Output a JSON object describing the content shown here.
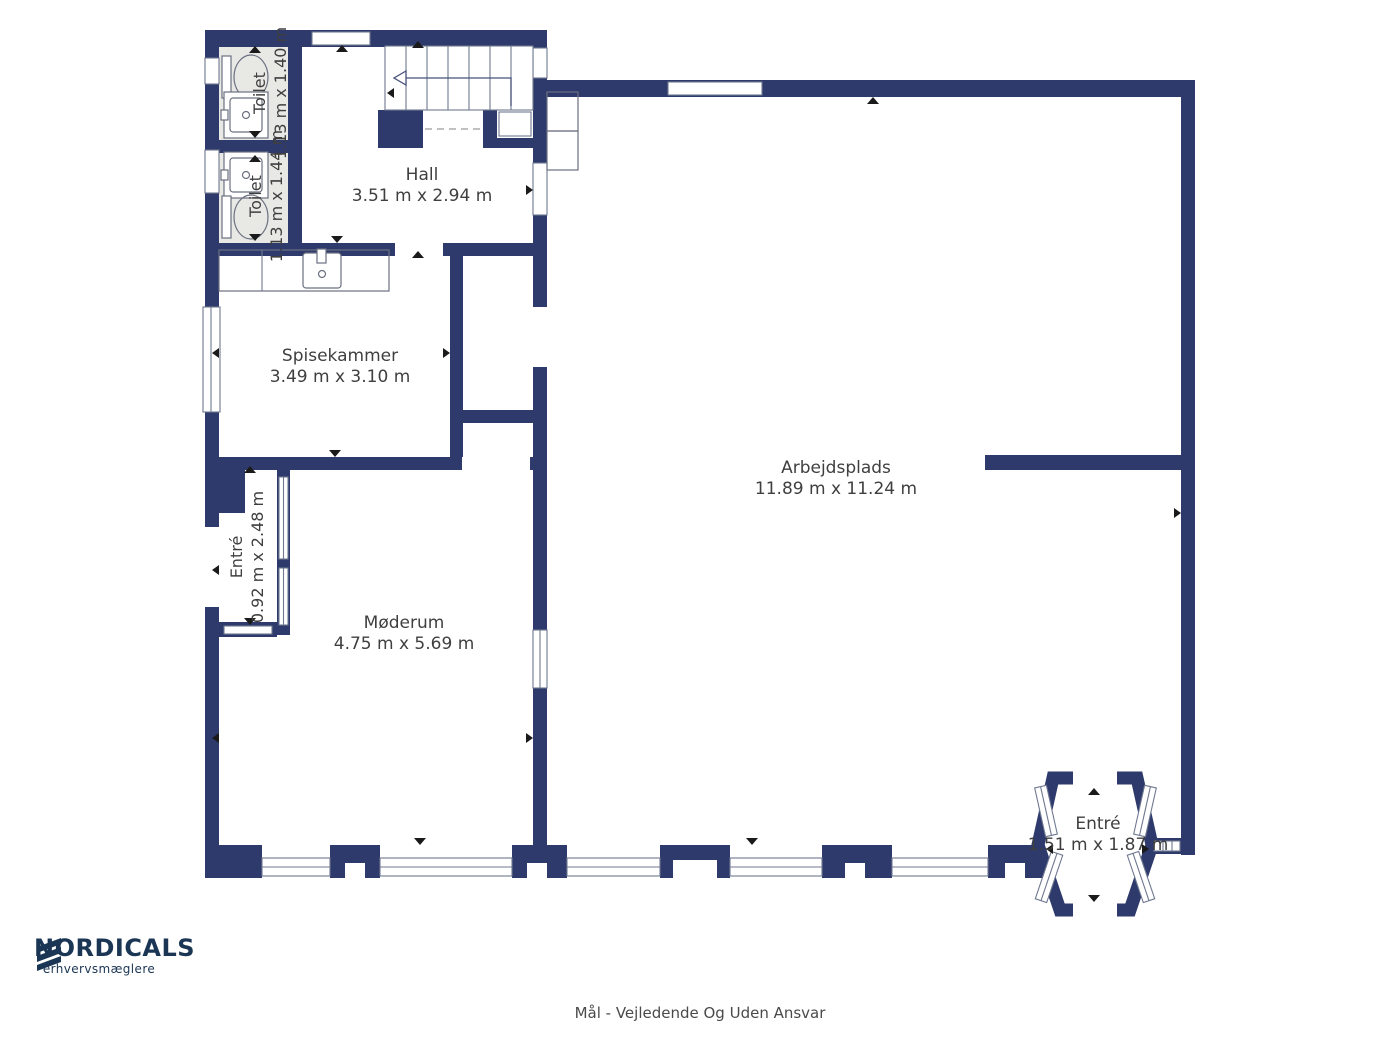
{
  "brand": {
    "name": "NORDICALS",
    "tagline": "erhvervsmæglere"
  },
  "disclaimer": "Mål - Vejledende Og Uden Ansvar",
  "colors": {
    "wall": "#2d3a6b",
    "toilet_floor": "#e8e8e4",
    "label_text": "#3f3f3f",
    "brand_navy": "#1b3554"
  },
  "rooms": {
    "hall": {
      "name": "Hall",
      "dims": "3.51 m x 2.94 m"
    },
    "toilet_top": {
      "name": "Toilet",
      "dims": "1.13 m x 1.40 m"
    },
    "toilet_bottom": {
      "name": "Toilet",
      "dims": "1.13 m x 1.44 m"
    },
    "spisekammer": {
      "name": "Spisekammer",
      "dims": "3.49 m x 3.10 m"
    },
    "entre_left": {
      "name": "Entré",
      "dims": "0.92 m x 2.48 m"
    },
    "moederum": {
      "name": "Møderum",
      "dims": "4.75 m x 5.69 m"
    },
    "arbejdsplads": {
      "name": "Arbejdsplads",
      "dims": "11.89 m x 11.24 m"
    },
    "entre_right": {
      "name": "Entré",
      "dims": "1.51 m x 1.87 m"
    }
  }
}
